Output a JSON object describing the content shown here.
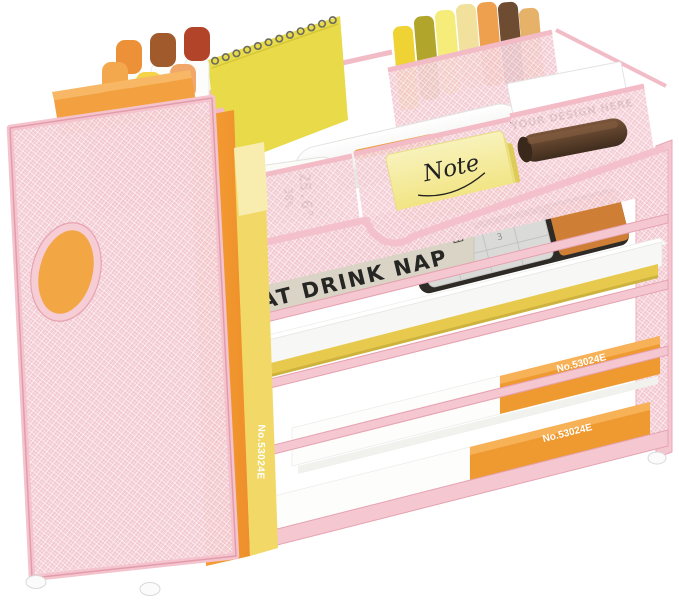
{
  "scene": {
    "description": "Pink mesh desk organizer with letter trays, a magazine file and supply compartments, styled with orange and yellow office supplies on a white background"
  },
  "organizer": {
    "labels": {
      "book_spine": "EAT DRINK NAP",
      "business_card": "YOUR DESIGN HERE",
      "sticky_note": "Note",
      "binder_vertical_orange": "No.53024E",
      "binder_vertical_yellow": "No.53024E",
      "paper_ream_middle": "No.53024E",
      "paper_ream_bottom": "No.53024E"
    },
    "thermometer": {
      "temperature_display": "25.6°",
      "humidity_display": "38%"
    },
    "calculator": {
      "visible_digits": [
        "1",
        "2",
        "3",
        "4",
        "5",
        "6"
      ]
    }
  },
  "colors": {
    "mesh_pink": "#f2c6cf",
    "frame_pink": "#f5c8d1",
    "accent_orange": "#ef9a31",
    "accent_yellow": "#e7ca4d",
    "note_yellow": "#f3e98f",
    "book_beige": "#d9d4c5",
    "leather_brown": "#503824",
    "background": "#ffffff"
  }
}
